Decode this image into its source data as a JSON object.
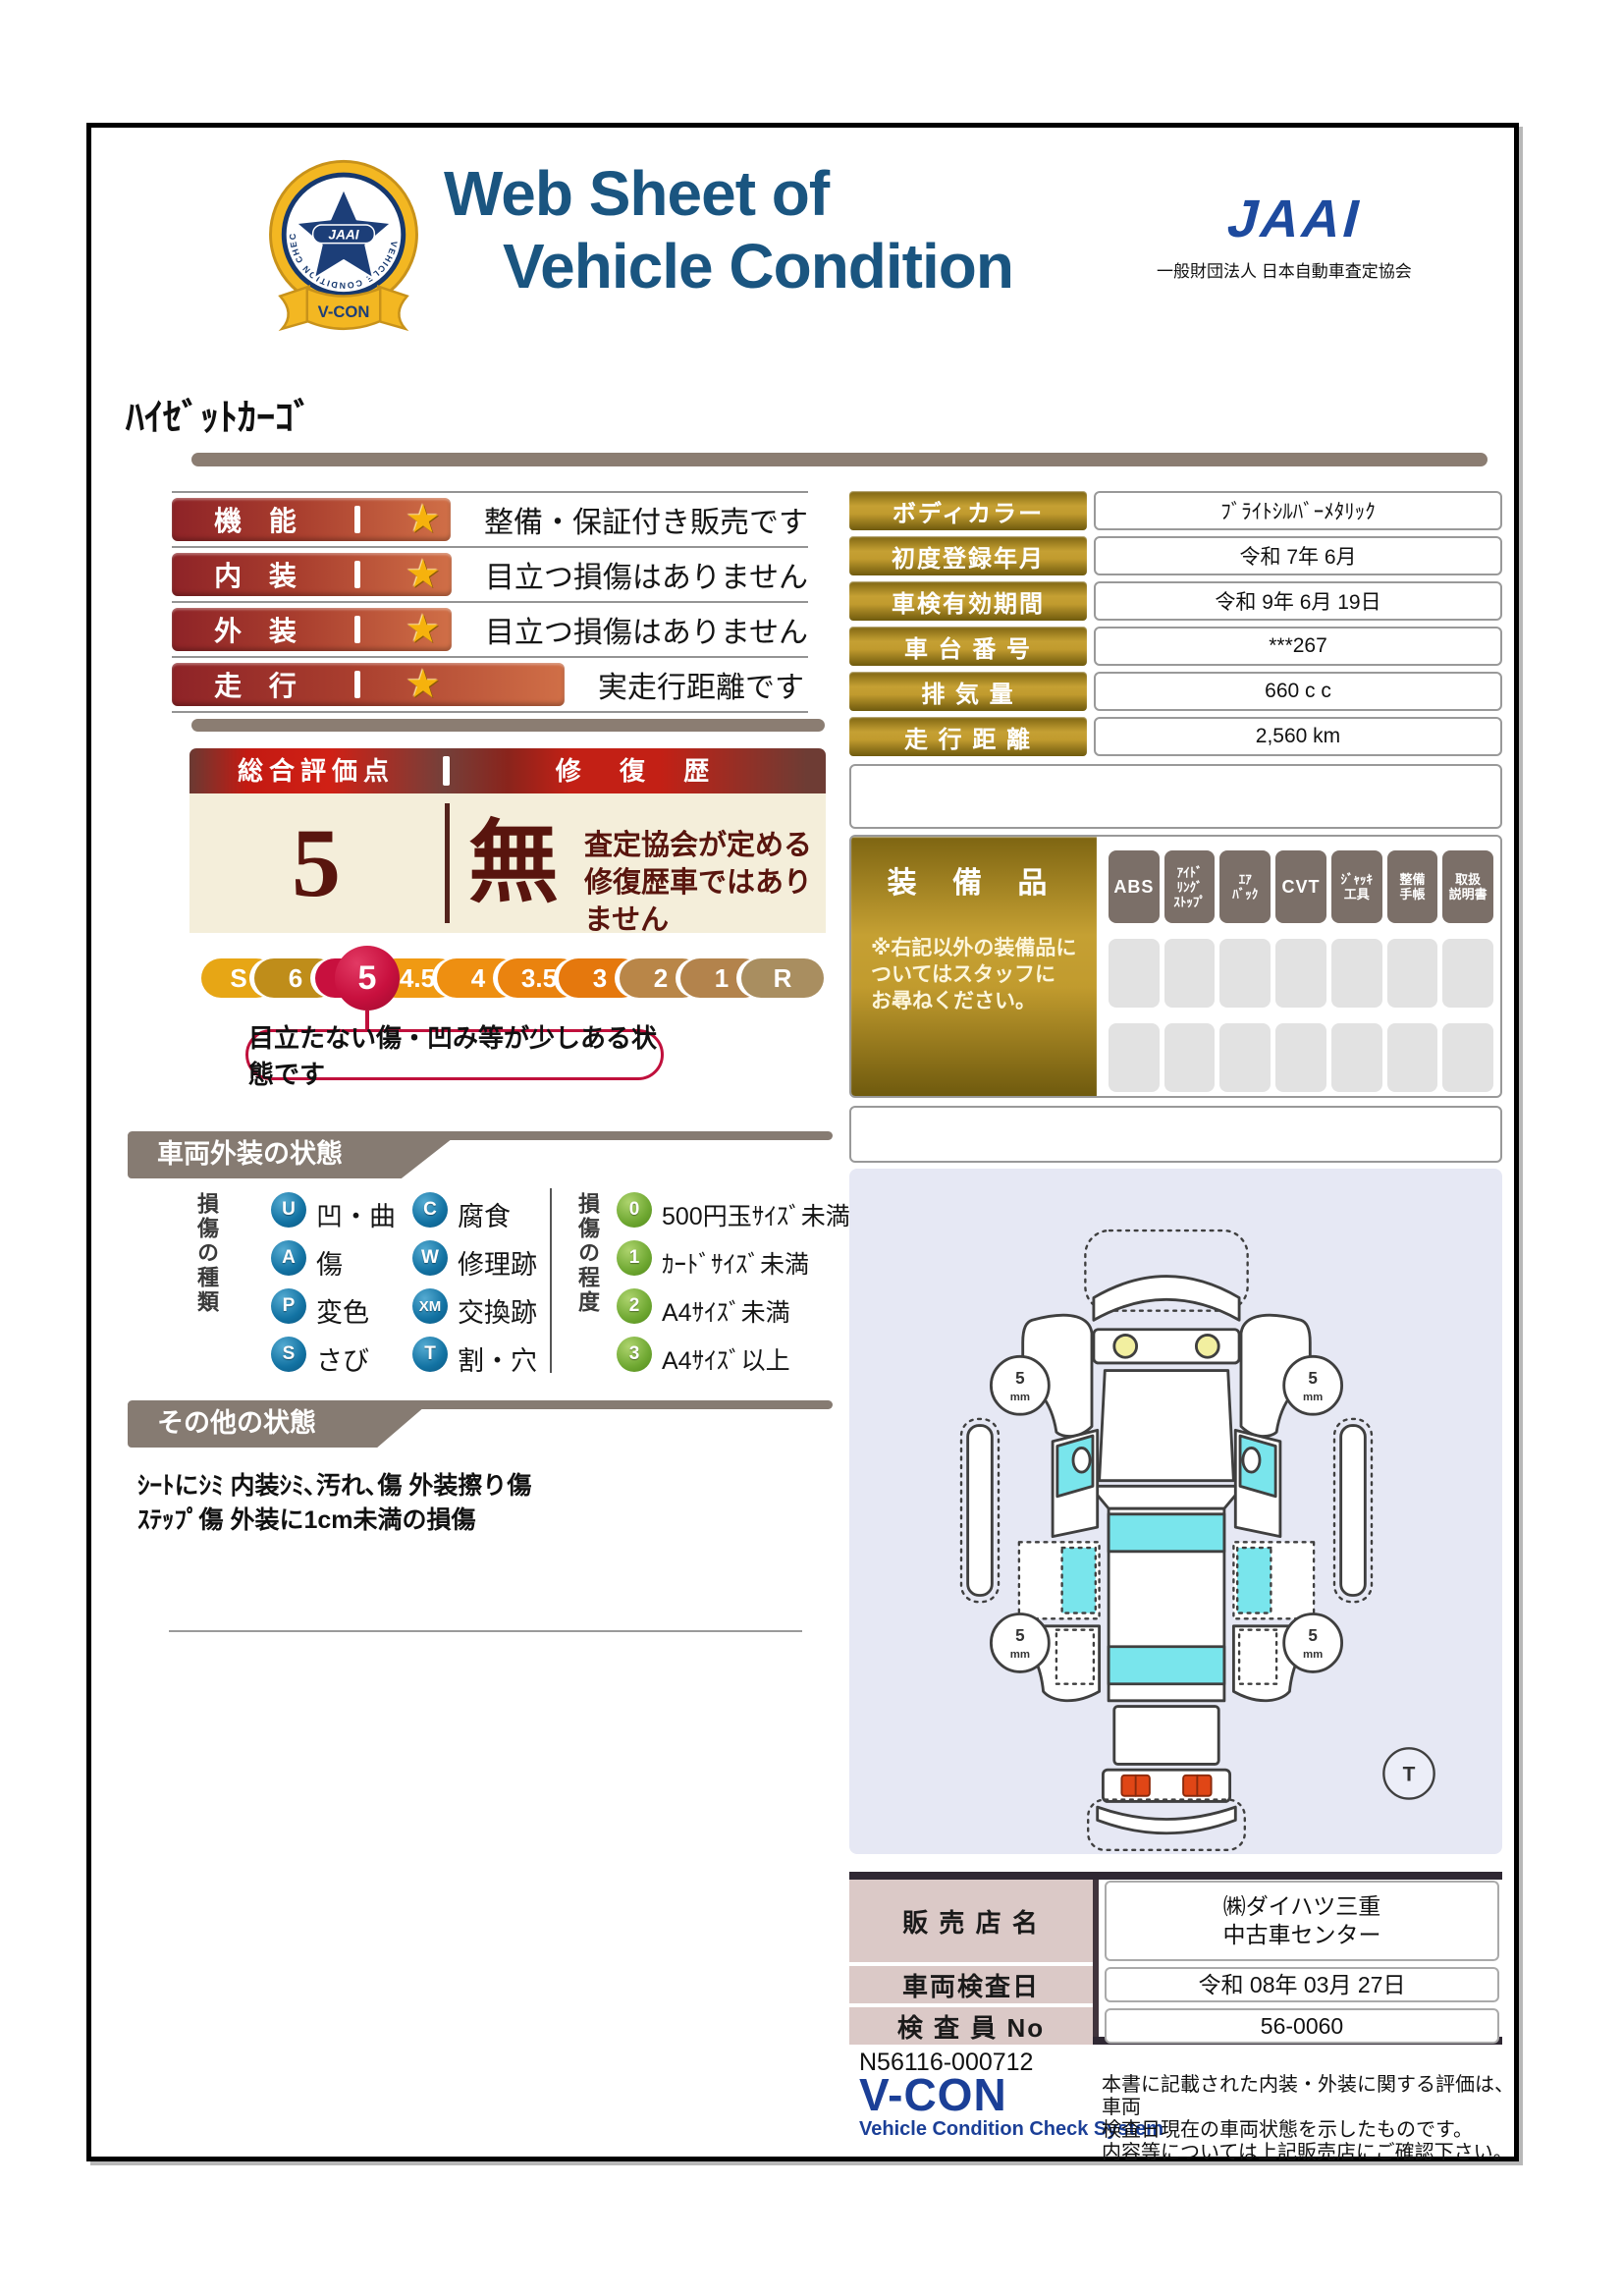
{
  "header": {
    "title_line1": "Web Sheet of",
    "title_line2": "Vehicle Condition",
    "jaai_logo": "JAAI",
    "jaai_subtitle": "一般財団法人 日本自動車査定協会",
    "badge": {
      "org": "JAAI",
      "ring_text": "VEHICLE CONDITION CHECK SYSTEM",
      "name": "V-CON"
    }
  },
  "vehicle_name": "ﾊｲｾﾞｯﾄｶｰｺﾞ",
  "ratings": [
    {
      "label": "機 能",
      "star": "★",
      "comment": "整備・保証付き販売です"
    },
    {
      "label": "内 装",
      "star": "★",
      "comment": "目立つ損傷はありません"
    },
    {
      "label": "外 装",
      "star": "★",
      "comment": "目立つ損傷はありません"
    },
    {
      "label": "走 行",
      "star": "★",
      "comment": "実走行距離です"
    }
  ],
  "overall": {
    "score_header": "総合評価点",
    "repair_header": "修 復 歴",
    "score": "5",
    "repair_value": "無",
    "repair_note": "査定協会が定める\n修復歴車ではありません",
    "scale": [
      "S",
      "6",
      "5",
      "4.5",
      "4",
      "3.5",
      "3",
      "2",
      "1",
      "R"
    ],
    "selected": "5",
    "callout": "目立たない傷・凹み等が少しある状態です"
  },
  "info_table": {
    "rows": [
      {
        "label": "ボディカラー",
        "value": "ﾌﾞﾗｲﾄｼﾙﾊﾞｰﾒﾀﾘｯｸ"
      },
      {
        "label": "初度登録年月",
        "value": "令和 7年 6月"
      },
      {
        "label": "車検有効期間",
        "value": "令和 9年 6月 19日"
      },
      {
        "label": "車 台 番 号",
        "value": "***267"
      },
      {
        "label": "排 気 量",
        "value": "660 c c"
      },
      {
        "label": "走 行 距 離",
        "value": "2,560 km"
      }
    ]
  },
  "equipment": {
    "title": "装 備 品",
    "note": "※右記以外の装備品に\nついてはスタッフに\nお尋ねください。",
    "badges": [
      "ABS",
      "ｱｲﾄﾞ\nﾘﾝｸﾞ\nｽﾄｯﾌﾟ",
      "ｴｱ\nﾊﾞｯｸ",
      "CVT",
      "ｼﾞｬｯｷ\n工具",
      "整備\n手帳",
      "取扱\n説明書"
    ],
    "empty_slots": 14
  },
  "exterior_section": {
    "title": "車両外装の状態",
    "type_label": "損傷の種類",
    "types": [
      {
        "code": "U",
        "label": "凹・曲"
      },
      {
        "code": "C",
        "label": "腐食"
      },
      {
        "code": "A",
        "label": "傷"
      },
      {
        "code": "W",
        "label": "修理跡"
      },
      {
        "code": "P",
        "label": "変色"
      },
      {
        "code": "XM",
        "label": "交換跡"
      },
      {
        "code": "S",
        "label": "さび"
      },
      {
        "code": "T",
        "label": "割・穴"
      }
    ],
    "degree_label": "損傷の程度",
    "degrees": [
      {
        "code": "0",
        "label": "500円玉ｻｲｽﾞ未満"
      },
      {
        "code": "1",
        "label": "ｶｰﾄﾞｻｲｽﾞ未満"
      },
      {
        "code": "2",
        "label": "A4ｻｲｽﾞ未満"
      },
      {
        "code": "3",
        "label": "A4ｻｲｽﾞ以上"
      }
    ]
  },
  "other_section": {
    "title": "その他の状態",
    "notes": [
      "ｼｰﾄにｼﾐ 内装ｼﾐ､汚れ､傷 外装擦り傷",
      "ｽﾃｯﾌﾟ傷 外装に1cm未満の損傷"
    ]
  },
  "diagram": {
    "tire_value": "5",
    "tire_unit": "mm",
    "t_mark": "T"
  },
  "dealer_table": {
    "rows": [
      {
        "label": "販 売 店 名",
        "value": "㈱ダイハツ三重\n中古車センター"
      },
      {
        "label": "車両検査日",
        "value": "令和 08年 03月 27日"
      },
      {
        "label": "検 査 員 No",
        "value": "56-0060"
      }
    ]
  },
  "footer": {
    "doc_no": "N56116-000712",
    "vcon": "V-CON",
    "vcon_sub": "Vehicle Condition Check System",
    "disclaimer": [
      "本書に記載された内装・外装に関する評価は、車両",
      "検査日現在の車両状態を示したものです。",
      "内容等については上記販売店にご確認下さい。"
    ]
  }
}
